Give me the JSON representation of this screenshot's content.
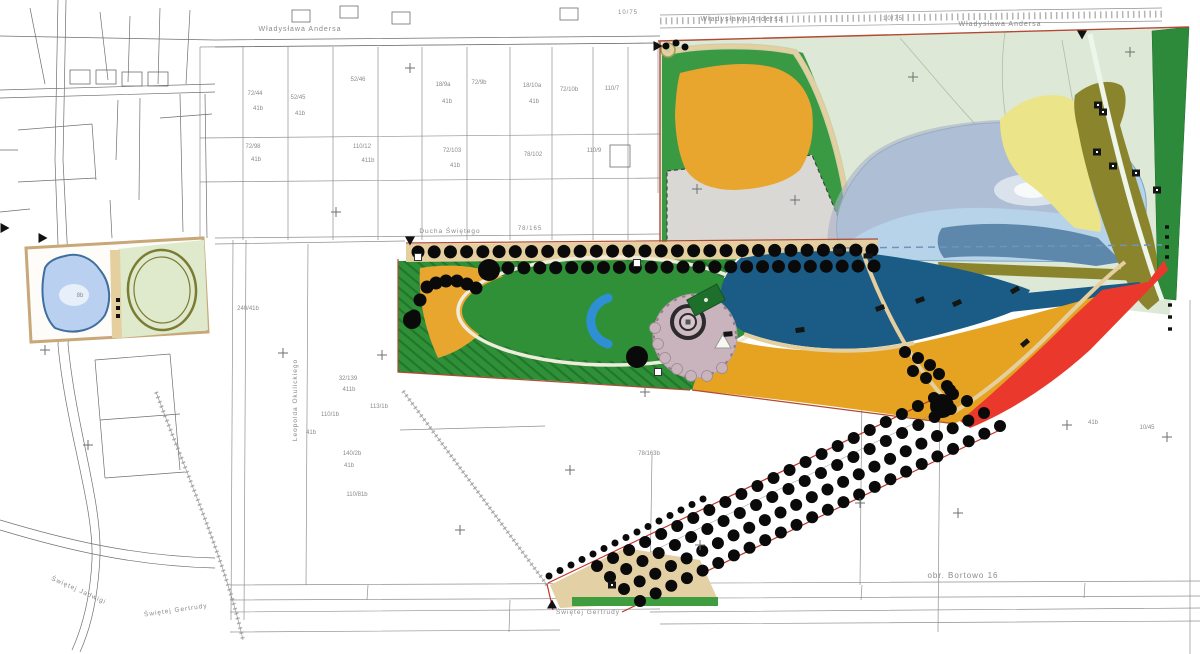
{
  "colors": {
    "page_bg": "#ffffff",
    "cadastral": "#909090",
    "cadastral_dark": "#6f6f6f",
    "label_gray": "#8a8a8a",
    "boundary": "#b04a32",
    "band_red": "#c03526",
    "mint": "#dde9d6",
    "mint_path": "#eef5ea",
    "orange": "#e9a62f",
    "amber": "#e5a321",
    "green_frame": "#3a9a43",
    "lawn": "#2f9038",
    "lawn_dark": "#20772c",
    "gray_parcel": "#dad8d4",
    "lake_light": "#b7d3ea",
    "lake_outline": "#7ba7c9",
    "lake_overlay": "#a9b1c6",
    "lake_steel": "#5d88ab",
    "lake_deep": "#1a5c86",
    "dash_blue": "#6f94bb",
    "red": "#ea392c",
    "strip_green": "#2c8a3a",
    "olive": "#8a852d",
    "pale_yellow": "#ece489",
    "tan": "#e5cf9f",
    "tan_light": "#cdd0a8",
    "tan_border": "#c8a878",
    "plaza": "#c9b3bc",
    "plaza_ring": "#2b2b2b",
    "pond": "#2f8fd4",
    "inset_lake": "#b9d0f0",
    "inset_lake_edge": "#3f6f9f",
    "inset_green": "#dfe9cc",
    "inset_loop": "#7b7b33",
    "hedge": "#3f9c3f",
    "beige": "#e3d0a4",
    "tree": "#0a0a0a",
    "white_path": "#f0ecdc"
  },
  "labels": {
    "streets": [
      {
        "t": "Władysława Andersa",
        "x": 300,
        "y": 31,
        "s": 7
      },
      {
        "t": "Władysława Andersa",
        "x": 742,
        "y": 21,
        "s": 7
      },
      {
        "t": "Władysława Andersa",
        "x": 1000,
        "y": 26,
        "s": 7
      },
      {
        "t": "10/75",
        "x": 893,
        "y": 20,
        "s": 6
      },
      {
        "t": "10/75",
        "x": 628,
        "y": 14,
        "s": 6
      },
      {
        "t": "Ducha Świętego",
        "x": 450,
        "y": 233,
        "s": 6.5
      },
      {
        "t": "78/165",
        "x": 530,
        "y": 230,
        "s": 6
      },
      {
        "t": "Leopolda Okulickiego",
        "x": 297,
        "y": 400,
        "s": 6.5,
        "r": -90
      },
      {
        "t": "obr. Bortowo 16",
        "x": 963,
        "y": 578,
        "s": 8
      },
      {
        "t": "Świętej Gertrudy",
        "x": 588,
        "y": 614,
        "s": 6.5
      },
      {
        "t": "Świętej Gertrudy",
        "x": 176,
        "y": 612,
        "s": 6.5,
        "r": -8
      },
      {
        "t": "Świętej Jadwigi",
        "x": 78,
        "y": 592,
        "s": 6.5,
        "r": 24
      }
    ],
    "parcels": [
      [
        "72/44",
        255,
        95
      ],
      [
        "41b",
        258,
        110
      ],
      [
        "52/45",
        298,
        99
      ],
      [
        "41b",
        300,
        115
      ],
      [
        "52/46",
        358,
        81
      ],
      [
        "72/98",
        253,
        148
      ],
      [
        "41b",
        256,
        161
      ],
      [
        "110/12",
        362,
        148
      ],
      [
        "411b",
        368,
        162
      ],
      [
        "18/9a",
        443,
        86
      ],
      [
        "41b",
        447,
        103
      ],
      [
        "72/9b",
        479,
        84
      ],
      [
        "18/10a",
        532,
        87
      ],
      [
        "41b",
        534,
        103
      ],
      [
        "72/10b",
        569,
        91
      ],
      [
        "110/7",
        612,
        90
      ],
      [
        "72/103",
        452,
        152
      ],
      [
        "41b",
        455,
        167
      ],
      [
        "78/102",
        533,
        156
      ],
      [
        "110/9",
        594,
        152
      ],
      [
        "240/41b",
        248,
        310
      ],
      [
        "32/139",
        348,
        380
      ],
      [
        "411b",
        349,
        391
      ],
      [
        "113/1b",
        379,
        408
      ],
      [
        "110/1b",
        330,
        416
      ],
      [
        "41b",
        311,
        434
      ],
      [
        "140/2b",
        352,
        455
      ],
      [
        "41b",
        349,
        467
      ],
      [
        "110/81b",
        357,
        496
      ],
      [
        "78/163b",
        649,
        455
      ],
      [
        "41b",
        1093,
        424
      ],
      [
        "10/45",
        1147,
        429
      ],
      [
        "8b",
        80,
        297
      ]
    ]
  },
  "trees": {
    "rows": [
      [
        418,
        252,
        872,
        250,
        29,
        6.5
      ],
      [
        508,
        268,
        874,
        266,
        24,
        6.5
      ],
      [
        640,
        601,
        1000,
        426,
        24,
        6
      ],
      [
        624,
        589,
        984,
        413,
        24,
        6
      ],
      [
        610,
        577,
        967,
        401,
        23,
        6
      ],
      [
        597,
        566,
        950,
        390,
        23,
        6
      ],
      [
        549,
        576,
        703,
        499,
        15,
        3.5
      ]
    ],
    "points": [
      [
        427,
        287,
        6.5
      ],
      [
        436,
        283,
        6.5
      ],
      [
        446,
        281,
        6.5
      ],
      [
        457,
        281,
        6.5
      ],
      [
        467,
        284,
        6.5
      ],
      [
        476,
        288,
        6.5
      ],
      [
        420,
        300,
        6.5
      ],
      [
        414,
        316,
        6.5
      ],
      [
        412,
        320,
        9
      ],
      [
        489,
        270,
        11
      ],
      [
        637,
        357,
        11
      ],
      [
        942,
        406,
        12
      ],
      [
        905,
        352,
        6
      ],
      [
        918,
        358,
        6
      ],
      [
        930,
        365,
        6
      ],
      [
        913,
        371,
        6
      ],
      [
        926,
        378,
        6
      ],
      [
        939,
        374,
        6
      ],
      [
        947,
        386,
        6
      ],
      [
        953,
        394,
        6
      ],
      [
        666,
        46,
        3.5
      ],
      [
        676,
        43,
        3.5
      ],
      [
        685,
        47,
        3.5
      ]
    ]
  },
  "markers": {
    "crosses": [
      [
        410,
        68
      ],
      [
        336,
        212
      ],
      [
        283,
        353
      ],
      [
        382,
        355
      ],
      [
        570,
        470
      ],
      [
        645,
        392
      ],
      [
        860,
        503
      ],
      [
        958,
        513
      ],
      [
        1067,
        425
      ],
      [
        1167,
        437
      ],
      [
        697,
        189
      ],
      [
        795,
        200
      ],
      [
        1130,
        52
      ],
      [
        913,
        77
      ],
      [
        700,
        545
      ],
      [
        460,
        530
      ],
      [
        88,
        445
      ],
      [
        45,
        350
      ]
    ],
    "triangles": [
      [
        4,
        228,
        90
      ],
      [
        42,
        238,
        90
      ],
      [
        410,
        240,
        180
      ],
      [
        657,
        46,
        90
      ],
      [
        1082,
        34,
        180
      ],
      [
        552,
        605,
        0
      ]
    ],
    "benches": [
      [
        728,
        334,
        -5
      ],
      [
        800,
        330,
        -8
      ],
      [
        880,
        308,
        -20
      ],
      [
        920,
        300,
        -20
      ],
      [
        957,
        303,
        -25
      ],
      [
        1015,
        290,
        -30
      ],
      [
        1025,
        343,
        -40
      ],
      [
        868,
        256,
        0
      ],
      [
        838,
        251,
        0
      ]
    ],
    "buildings": [
      [
        1098,
        105
      ],
      [
        1103,
        112
      ],
      [
        1097,
        152
      ],
      [
        1113,
        166
      ],
      [
        1136,
        173
      ],
      [
        1157,
        190
      ],
      [
        612,
        585
      ]
    ],
    "junctions": [
      [
        418,
        257
      ],
      [
        637,
        263
      ],
      [
        658,
        372
      ]
    ],
    "edge_marks": [
      [
        1167,
        227
      ],
      [
        1167,
        237
      ],
      [
        1167,
        247
      ],
      [
        1167,
        257
      ],
      [
        1170,
        305
      ],
      [
        1170,
        317
      ],
      [
        1170,
        329
      ]
    ]
  }
}
